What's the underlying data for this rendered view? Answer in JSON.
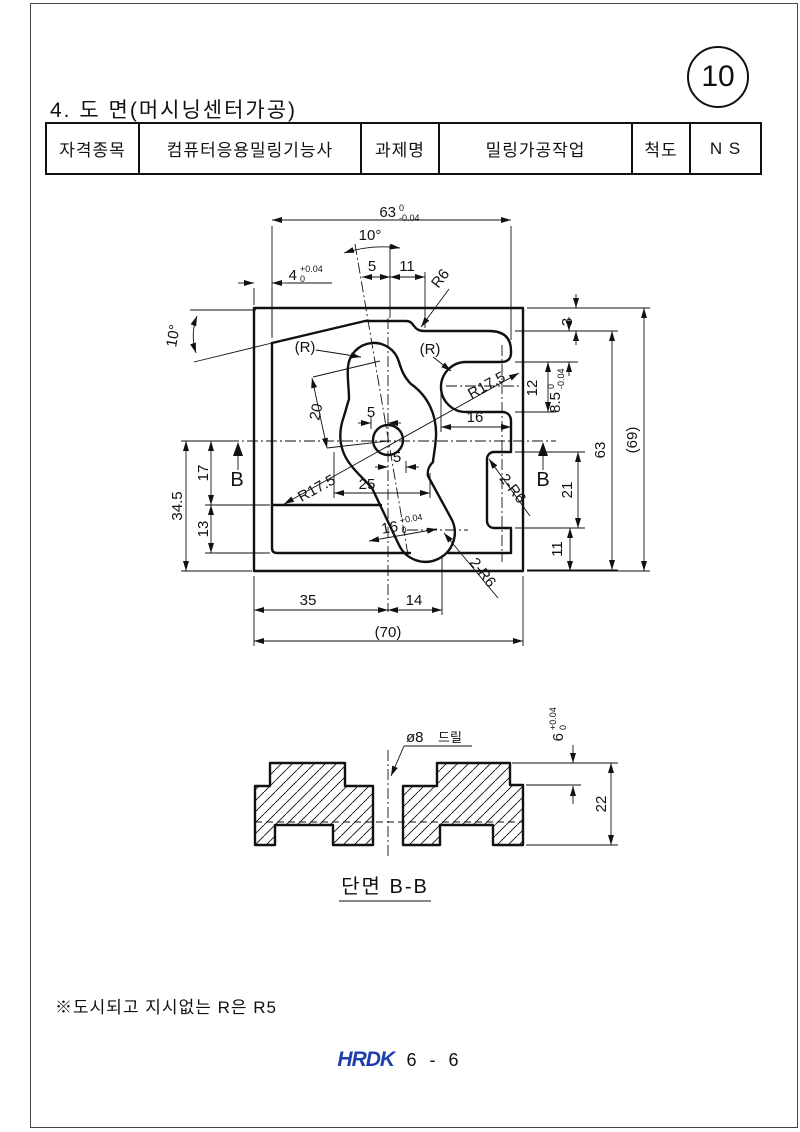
{
  "page": {
    "badge": "10",
    "title": "4. 도 면(머시닝센터가공)",
    "note": "※도시되고 지시없는 R은 R5",
    "logo": "HRDK",
    "page_no": "6 - 6"
  },
  "table": {
    "col1_header": "자격종목",
    "col1_value": "컴퓨터응용밀링기능사",
    "col2_header": "과제명",
    "col2_value": "밀링가공작업",
    "col3_header": "척도",
    "col3_value": "N S"
  },
  "tv": {
    "w63": {
      "v": "63",
      "t": "0",
      "b": "-0.04"
    },
    "ang_top": "10°",
    "ang_left": "10°",
    "d5_top": "5",
    "d11_top": "11",
    "d4": {
      "v": "4",
      "t": "+0.04",
      "b": "0"
    },
    "r6": "R6",
    "rref_l": "(R)",
    "rref_r": "(R)",
    "r175_u": "R17.5",
    "r175_l": "R17.5",
    "d20": "20",
    "d5_mid": "5",
    "d5_low": "5",
    "d25": "25",
    "d16_slot": {
      "v": "16",
      "t": "+0.04",
      "b": "0"
    },
    "d16": "16",
    "d12": "12",
    "d85": {
      "v": "8.5",
      "t": "0",
      "b": "-0.04"
    },
    "d3": "3",
    "h63": "63",
    "h69": "(69)",
    "d21": "21",
    "d11_r": "11",
    "r2r6_u": "2-R6",
    "r2r6_b": "2-R6",
    "d345": "34.5",
    "d17": "17",
    "d13": "13",
    "d35": "35",
    "d14": "14",
    "w70": "(70)",
    "b_l": "B",
    "b_r": "B"
  },
  "sv": {
    "title": "단면 B-B",
    "drill": "ø8",
    "drill2": "드릴",
    "d6": {
      "v": "6",
      "t": "+0.04",
      "b": "0"
    },
    "d22": "22"
  }
}
